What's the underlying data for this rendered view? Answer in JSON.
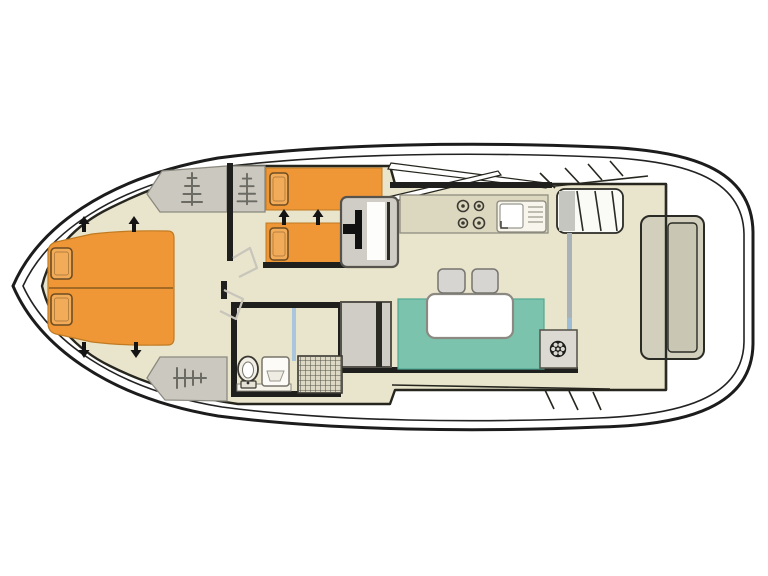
{
  "diagram": {
    "kind": "houseboat-deck-plan",
    "orientation": "bow-left"
  },
  "counts": {
    "double_berths": 1,
    "single_berths": 2,
    "pillows": 4,
    "stove_burners": 4,
    "dinette_stools": 2,
    "wardrobes": 3,
    "bed_extension_arrows": 6
  },
  "icons": {
    "wardrobe": "coat-rack-icon",
    "helm": "ships-wheel-icon",
    "stove": "four-burner-hob-icon",
    "sink": "sink-with-drainer-icon",
    "toilet": "toilet-icon",
    "shower": "shower-grate-icon",
    "bed_extension": "arrow-icon"
  },
  "colors": {
    "background": "#ffffff",
    "deck": "#ffffff",
    "hull_line": "#1c1c1c",
    "cabin_floor": "#e9e4cc",
    "counter": "#dcd7bf",
    "bed_orange": "#ef9637",
    "pillow_orange": "#f2ab58",
    "pillow_border": "#6d4d22",
    "wardrobe_gray": "#cbc8c0",
    "symbol_gray": "#6b6b63",
    "seating_teal": "#7cc3ae",
    "table_white": "#ffffff",
    "stool_gray": "#d7d5d1",
    "door_gray": "#cfcdc5",
    "wall_black": "#1f1f1e",
    "door_swing_gray": "#c8c5ba",
    "shower_screen_blue": "#a9c6dc",
    "shower_base": "#dcd8c3",
    "sliding_door_gray": "#a9b2b6",
    "sliding_door_blue": "#9cbdd4",
    "stern_bench": "#d2d0bd",
    "steps_white": "#fafaf7",
    "steps_shade": "#c6c6c0",
    "arrow_black": "#141414",
    "helm_black": "#1d1d1d",
    "fixture_white": "#f2f0e6"
  }
}
